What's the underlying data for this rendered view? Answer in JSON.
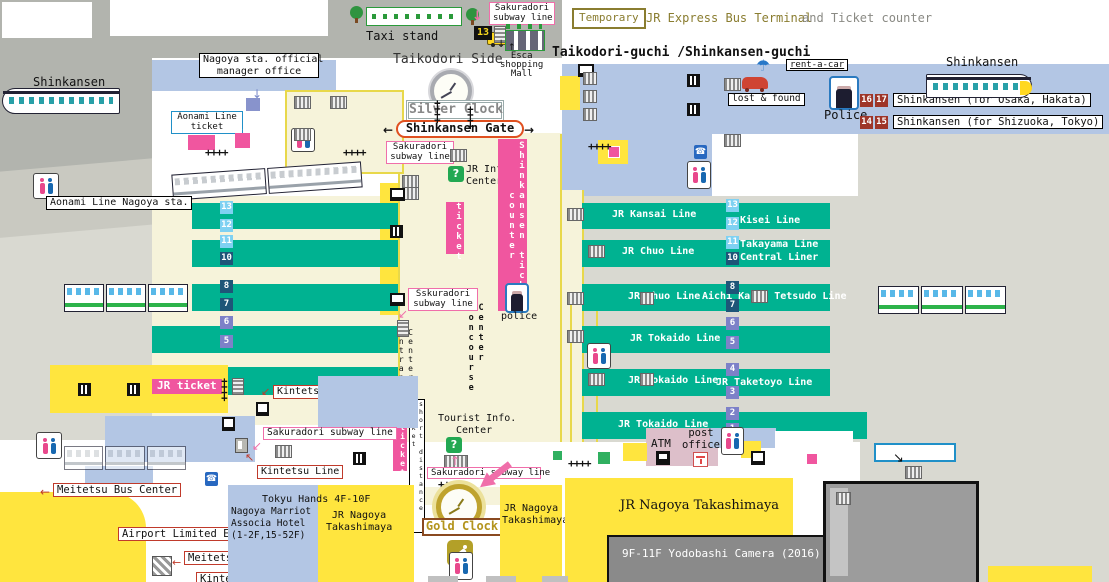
{
  "title": "Nagoya Station area map",
  "colors": {
    "platform_teal": "#00b291",
    "building_blue": "#b3c6e4",
    "shop_yellow": "#ffe53e",
    "concourse_cream": "#f6f3da",
    "ticket_pink": "#f0569f",
    "street_gray": "#b2b4ae",
    "street_light": "#d9d9d1",
    "badge_light_blue": "#7fd1f2",
    "badge_navy": "#1e5578",
    "badge_slate": "#7d81c8",
    "badge_dark_red": "#9e3528",
    "gold": "#b3941c",
    "olive": "#8a7d30"
  },
  "icons": {
    "arrow_left": "←",
    "arrow_right": "→",
    "arrow_up": "↑",
    "arrow_down": "↓",
    "arrow_down_left": "↙",
    "arrow_up_left": "↖",
    "arrow_down_right": "↘",
    "umbrella": "☂",
    "phone": "☎",
    "question": "?",
    "gates": "++++"
  },
  "common": {
    "sakuradori_1": "Sakuradori",
    "sakuradori_2": "subway line"
  },
  "top": {
    "taxi_stand": "Taxi stand",
    "bus_13": "13",
    "taikodori_side": "Taikodori Side",
    "esca_1": "Esca",
    "esca_2": "shopping",
    "esca_3": "Mall",
    "taikodori_guchi": "Taikodori-guchi /Shinkansen-guchi",
    "temporary": "Temporary",
    "jr_express": "JR Express Bus Terminal",
    "and_ticket": "and Ticket counter",
    "manager_office_1": "Nagoya sta. official",
    "manager_office_2": "manager office",
    "shinkansen_w": "Shinkansen",
    "shinkansen_e": "Shinkansen",
    "rent_a_car": "rent-a-car",
    "lost_found": "lost & found",
    "police": "Police",
    "p16": "16",
    "p17": "17",
    "p14": "14",
    "p15": "15",
    "shink_osaka": "Shinkansen (for Osaka, Hakata)",
    "shink_tokyo": "Shinkansen (for Shizuoka, Tokyo)",
    "silver_clock": "Silver Clock",
    "shinkansen_gate": "Shinkansen Gate"
  },
  "west": {
    "aonami_ticket_1": "Aonami Line",
    "aonami_ticket_2": "ticket",
    "ticket_white": "ticket",
    "aonami_station": "Aonami Line Nagoya sta.",
    "jr_ticket": "JR ticket",
    "kintetsu_platform": "Kintetsu Line",
    "kintetsu_mid": "Kintetsu Line",
    "meitetsu_bus": "Meitetsu Bus Center",
    "airport_exp": "Airport Limited Exp.",
    "meitetsu_line": "Meitetsu Line",
    "kintetsu_s": "Kintetsu Line"
  },
  "center": {
    "sskuradori_1": "Sskuradori",
    "sskuradori_2": "subway line",
    "jr_info_1": "JR Info.",
    "jr_info_2": "Center",
    "ticket": "ticket",
    "ticket2": "ticket",
    "shink_counter": "Shinkansen ticket counter",
    "police": "police",
    "center_concourse": "Center Concourse",
    "center_entrance": "Center Entrance",
    "short_distance": "short distance ticket",
    "tourist_1": "Tourist Info.",
    "tourist_2": "Center"
  },
  "platforms": {
    "left_numbers": [
      "13",
      "12",
      "11",
      "10",
      "8",
      "7",
      "6",
      "5"
    ],
    "right_numbers": [
      "13",
      "12",
      "11",
      "10",
      "8",
      "7",
      "6",
      "5",
      "4",
      "3",
      "2",
      "1"
    ],
    "lines": {
      "kansai": "JR Kansai Line",
      "kisei": "Kisei Line",
      "chuo_a": "JR Chuo Line",
      "takayama": "Takayama Line",
      "central": "Central Liner",
      "chuo_b": "JR Chuo Line",
      "aichi": "Aichi Kanjo Tetsudo Line",
      "tokaido_a": "JR Tokaido Line",
      "tokaido_b": "JR Tokaido Line",
      "taketoyo": "JR Taketoyo Line",
      "tokaido_c": "JR Tokaido Line"
    }
  },
  "south": {
    "tokyu_hands": "Tokyu Hands 4F-10F",
    "marriott_1": "Nagoya Marriot",
    "marriott_2": "Associa Hotel",
    "marriott_3": "(1-2F,15-52F)",
    "takashimaya_a1": "JR Nagoya",
    "takashimaya_a2": "Takashimaya",
    "gold_clock": "Gold Clock",
    "takashimaya_b1": "JR Nagoya",
    "takashimaya_b2": "Takashimaya",
    "takashimaya_big": "JR Nagoya Takashimaya",
    "yodobashi": "9F-11F Yodobashi Camera (2016)",
    "atm": "ATM",
    "post_1": "post",
    "post_2": "office"
  }
}
